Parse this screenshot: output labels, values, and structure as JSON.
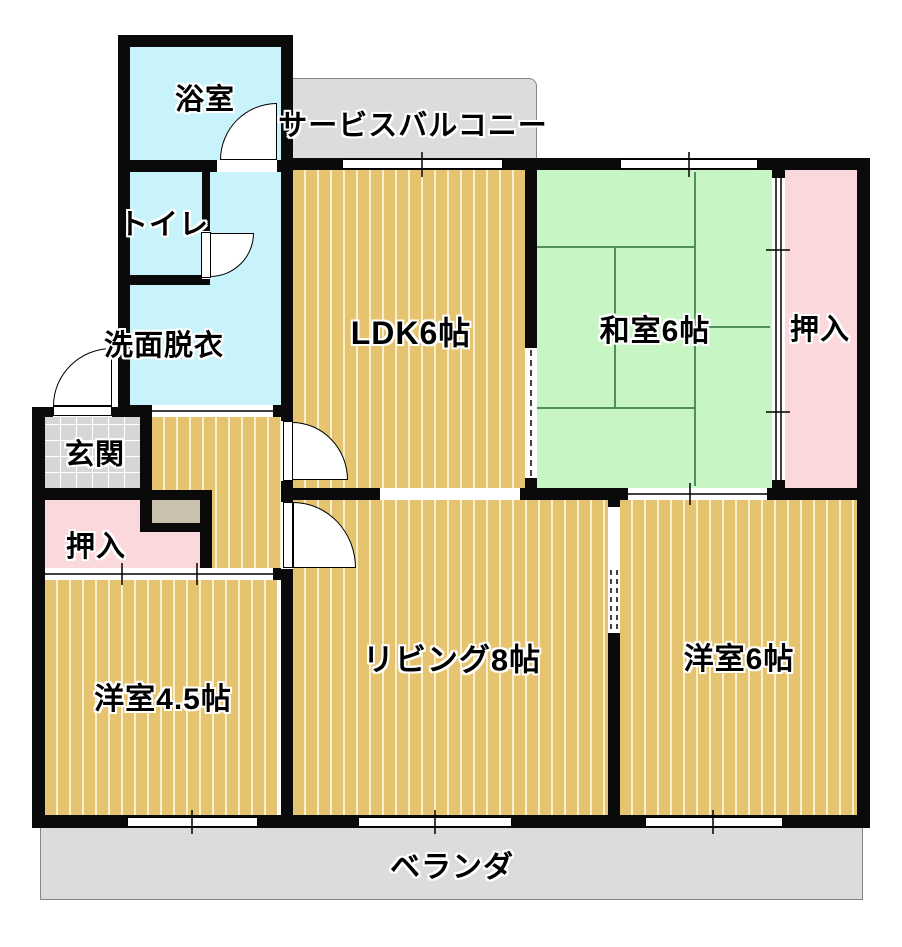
{
  "figure": "japanese-apartment-floor-plan",
  "rooms": {
    "bath": {
      "label": "浴室"
    },
    "service_balcony set": {
      "label": ""
    },
    "service_balcony": {
      "label": "サービスバルコニー"
    },
    "toilet": {
      "label": "トイレ"
    },
    "washroom": {
      "label": "洗面脱衣"
    },
    "ldk": {
      "label": "LDK6帖"
    },
    "washitsu": {
      "label": "和室6帖"
    },
    "closet_right": {
      "label": "押入"
    },
    "genkan": {
      "label": "玄関"
    },
    "closet_left": {
      "label": "押入"
    },
    "western_4_5": {
      "label": "洋室4.5帖"
    },
    "living": {
      "label": "リビング8帖"
    },
    "western_6": {
      "label": "洋室6帖"
    },
    "veranda": {
      "label": "ベランダ"
    }
  },
  "colors": {
    "wall": "#0a0a0a",
    "wood": "#e5c36f",
    "wood-stripe": "#f8f0cd",
    "tatami": "#c7f5c4",
    "tatami-line": "#4f8f5b",
    "water": "#c9f3fb",
    "closet": "#fad8dc",
    "balcony": "#dcdcdc",
    "tile": "#d6d6d6",
    "cabinet": "#c9c0ad"
  }
}
